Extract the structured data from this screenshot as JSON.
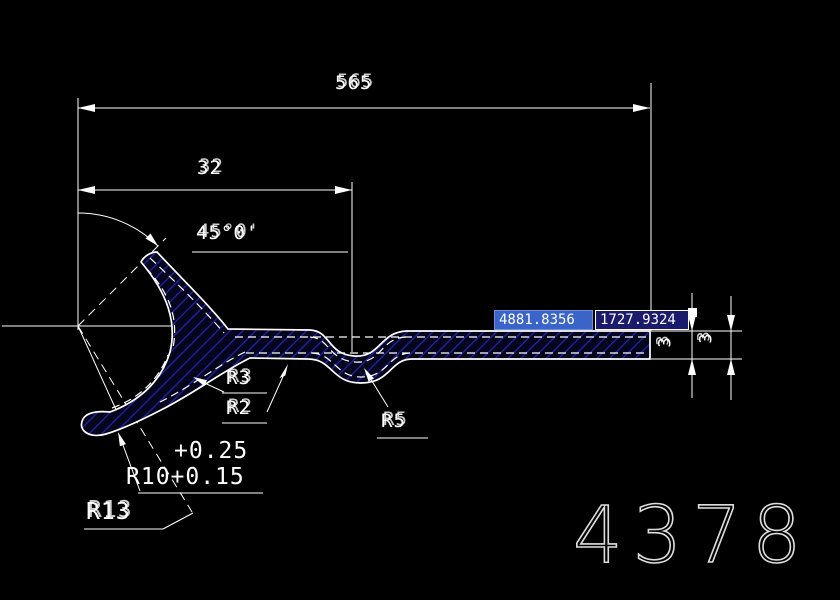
{
  "canvas": {
    "background": "#000000",
    "line_color": "#ffffff",
    "hatch_color": "#2222aa"
  },
  "dimensions": {
    "width_total": "565",
    "width_left": "32",
    "angle": "45°0'",
    "thickness_inner": "3",
    "thickness_outer": "3"
  },
  "annotations": {
    "fillet_top": "R3",
    "fillet_bottom": "R2",
    "fillet_dip": "R5",
    "tol_upper": "+0.25",
    "radius_main": "R10+0.15",
    "radius_left": "R13"
  },
  "coord_input": {
    "x_value": "4881.8356",
    "y_value": "1727.9324",
    "x_bg": "#3a64c8",
    "y_bg": "#1b1b6e"
  },
  "drawing_number": "4378"
}
